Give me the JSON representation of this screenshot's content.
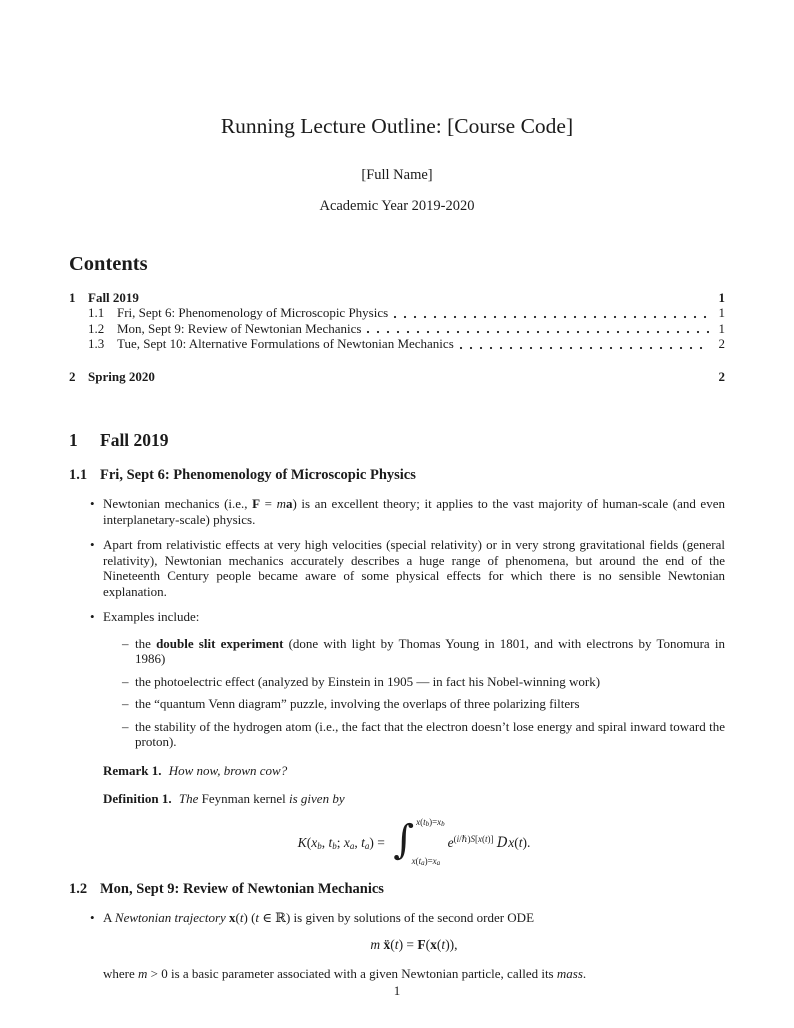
{
  "header": {
    "title": "Running Lecture Outline: [Course Code]",
    "author": "[Full Name]",
    "date": "Academic Year 2019-2020"
  },
  "contents": {
    "heading": "Contents",
    "entries": [
      {
        "number": "1",
        "title": "Fall 2019",
        "page": "1",
        "level": 1
      },
      {
        "number": "1.1",
        "title": "Fri, Sept 6: Phenomenology of Microscopic Physics",
        "page": "1",
        "level": 2
      },
      {
        "number": "1.2",
        "title": "Mon, Sept 9: Review of Newtonian Mechanics",
        "page": "1",
        "level": 2
      },
      {
        "number": "1.3",
        "title": "Tue, Sept 10: Alternative Formulations of Newtonian Mechanics",
        "page": "2",
        "level": 2
      },
      {
        "number": "2",
        "title": "Spring 2020",
        "page": "2",
        "level": 1
      }
    ]
  },
  "markers": {
    "bullet": "•",
    "dash": "–"
  },
  "sections": {
    "fall": {
      "number": "1",
      "title": "Fall 2019"
    },
    "sub1": {
      "number": "1.1",
      "title": "Fri, Sept 6: Phenomenology of Microscopic Physics"
    },
    "sub2": {
      "number": "1.2",
      "title": "Mon, Sept 9: Review of Newtonian Mechanics"
    }
  },
  "body": {
    "bullet1": [
      {
        "t": "Newtonian mechanics (i.e., "
      },
      {
        "t": "F",
        "c": "bf"
      },
      {
        "t": " = "
      },
      {
        "t": "m",
        "c": "it"
      },
      {
        "t": "a",
        "c": "bf"
      },
      {
        "t": ") is an excellent theory; it applies to the vast majority of human-scale (and even interplanetary-scale) physics."
      }
    ],
    "bullet2": "Apart from relativistic effects at very high velocities (special relativity) or in very strong gravitational fields (general relativity), Newtonian mechanics accurately describes a huge range of phenomena, but around the end of the Nineteenth Century people became aware of some physical effects for which there is no sensible Newtonian explanation.",
    "bullet3": "Examples include:",
    "sub_items": {
      "d1": [
        {
          "t": "the "
        },
        {
          "t": "double slit experiment",
          "c": "bf"
        },
        {
          "t": " (done with light by Thomas Young in 1801, and with electrons by Tonomura in 1986)"
        }
      ],
      "d2": "the photoelectric effect (analyzed by Einstein in 1905 — in fact his Nobel-winning work)",
      "d3": "the “quantum Venn diagram” puzzle, involving the overlaps of three polarizing filters",
      "d4": "the stability of the hydrogen atom (i.e., the fact that the electron doesn’t lose energy and spiral inward toward the proton)."
    },
    "remark": [
      {
        "t": "Remark 1.",
        "c": "bf gap"
      },
      {
        "t": " "
      },
      {
        "t": "How now, brown cow?",
        "c": "it"
      }
    ],
    "definition": [
      {
        "t": "Definition 1.",
        "c": "bf gap"
      },
      {
        "t": " "
      },
      {
        "t": "The ",
        "c": "it"
      },
      {
        "t": "Feynman kernel"
      },
      {
        "t": " is given by",
        "c": "it"
      }
    ],
    "kernel_formula": [
      {
        "t": "K",
        "c": "it"
      },
      {
        "t": "("
      },
      {
        "t": "x",
        "c": "it"
      },
      {
        "t": "b",
        "c": "sub"
      },
      {
        "t": ", "
      },
      {
        "t": "t",
        "c": "it"
      },
      {
        "t": "b",
        "c": "sub"
      },
      {
        "t": "; "
      },
      {
        "t": "x",
        "c": "it"
      },
      {
        "t": "a",
        "c": "sub"
      },
      {
        "t": ", "
      },
      {
        "t": "t",
        "c": "it"
      },
      {
        "t": "a",
        "c": "sub"
      },
      {
        "t": ") = "
      },
      {
        "c": "int",
        "g": [
          {
            "t": "∫",
            "c": "int-sign"
          },
          {
            "c": "int-lims",
            "g": [
              {
                "c": "lim lim-top",
                "g": [
                  {
                    "t": "x",
                    "c": "it"
                  },
                  {
                    "t": "("
                  },
                  {
                    "t": "t",
                    "c": "it"
                  },
                  {
                    "t": "b",
                    "c": "nsub"
                  },
                  {
                    "t": ")="
                  },
                  {
                    "t": "x",
                    "c": "it"
                  },
                  {
                    "t": "b",
                    "c": "nsub"
                  }
                ]
              },
              {
                "c": "lim lim-bot",
                "g": [
                  {
                    "t": "x",
                    "c": "it"
                  },
                  {
                    "t": "("
                  },
                  {
                    "t": "t",
                    "c": "it"
                  },
                  {
                    "t": "a",
                    "c": "nsub"
                  },
                  {
                    "t": ")="
                  },
                  {
                    "t": "x",
                    "c": "it"
                  },
                  {
                    "t": "a",
                    "c": "nsub"
                  }
                ]
              }
            ]
          }
        ]
      },
      {
        "t": "e",
        "c": "it"
      },
      {
        "c": "sup",
        "g": [
          {
            "t": "("
          },
          {
            "t": "i",
            "c": "it"
          },
          {
            "t": "/ℏ)"
          },
          {
            "t": "S",
            "c": "it"
          },
          {
            "t": "["
          },
          {
            "t": "x",
            "c": "it"
          },
          {
            "t": "("
          },
          {
            "t": "t",
            "c": "it"
          },
          {
            "t": ")]"
          }
        ]
      },
      {
        "t": " "
      },
      {
        "t": "D",
        "c": "scrD"
      },
      {
        "t": "x",
        "c": "it"
      },
      {
        "t": "("
      },
      {
        "t": "t",
        "c": "it"
      },
      {
        "t": ")."
      }
    ],
    "bullet4": [
      {
        "t": "A "
      },
      {
        "t": "Newtonian trajectory",
        "c": "it"
      },
      {
        "t": " "
      },
      {
        "t": "x",
        "c": "bf"
      },
      {
        "t": "("
      },
      {
        "t": "t",
        "c": "it"
      },
      {
        "t": ") ("
      },
      {
        "t": "t",
        "c": "it"
      },
      {
        "t": " ∈ ℝ) is given by solutions of the second order ODE"
      }
    ],
    "newton_formula": [
      {
        "t": "m",
        "c": "it"
      },
      {
        "t": " "
      },
      {
        "t": "ẍ",
        "c": "bf"
      },
      {
        "t": "("
      },
      {
        "t": "t",
        "c": "it"
      },
      {
        "t": ") = "
      },
      {
        "t": "F",
        "c": "bf"
      },
      {
        "t": "("
      },
      {
        "t": "x",
        "c": "bf"
      },
      {
        "t": "("
      },
      {
        "t": "t",
        "c": "it"
      },
      {
        "t": ")),"
      }
    ],
    "where_mass": [
      {
        "t": "where "
      },
      {
        "t": "m",
        "c": "it"
      },
      {
        "t": " > 0 is a basic parameter associated with a given Newtonian particle, called its "
      },
      {
        "t": "mass",
        "c": "it"
      },
      {
        "t": "."
      }
    ]
  },
  "footer": {
    "page_number": "1"
  }
}
